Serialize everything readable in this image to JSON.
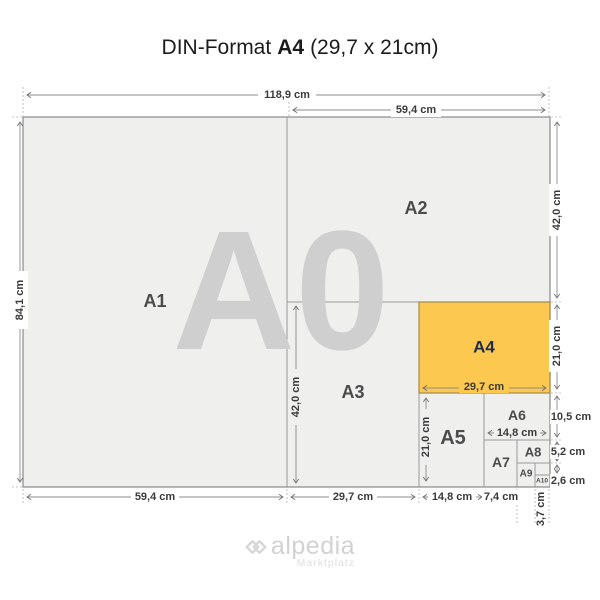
{
  "title": {
    "prefix": "DIN-Format",
    "highlight": "A4",
    "suffix": "(29,7 x 21cm)"
  },
  "watermark": "A0",
  "labels": {
    "a1": "A1",
    "a2": "A2",
    "a3": "A3",
    "a4": "A4",
    "a5": "A5",
    "a6": "A6",
    "a7": "A7",
    "a8": "A8",
    "a9": "A9",
    "a10": "A10"
  },
  "dimensions": {
    "total_width": "118,9 cm",
    "a2_width": "59,4 cm",
    "total_height": "84,1 cm",
    "a2_height": "42,0 cm",
    "a4_height": "21,0 cm",
    "a6_height": "10,5 cm",
    "a8_height": "5,2 cm",
    "a10_height": "2,6 cm",
    "a3_height": "42,0 cm",
    "a5_height": "21,0 cm",
    "a4_width": "29,7 cm",
    "a6_width": "14,8 cm",
    "a1_width": "59,4 cm",
    "a3_width": "29,7 cm",
    "a5_width": "14,8 cm",
    "a7_width": "7,4 cm",
    "a10_width": "3,7 cm"
  },
  "logo": {
    "name": "alpedia",
    "tagline": "Marktplatz"
  },
  "colors": {
    "highlight": "#fdc84f",
    "paper": "#efefee",
    "line": "#8c8c8c",
    "watermark": "#cfcfcf",
    "label": "#4b4b4b",
    "a4_label": "#1d2b4a"
  }
}
